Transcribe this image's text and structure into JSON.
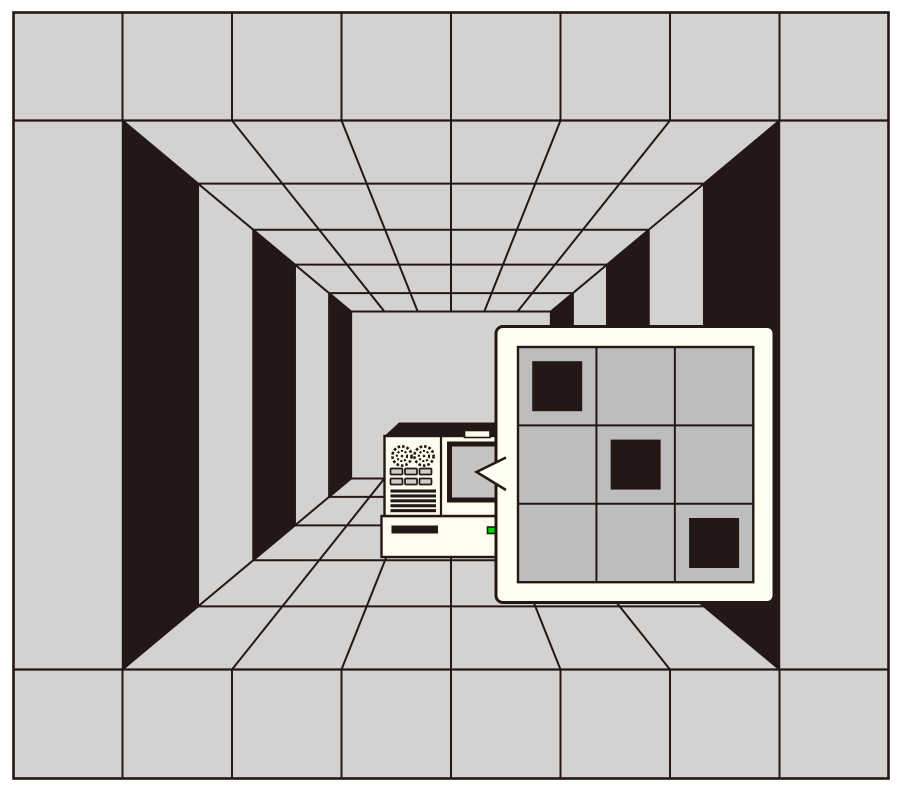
{
  "illustration": {
    "kind": "one-point-perspective corridor with computer and magnified screen callout",
    "has_text": false
  },
  "colors": {
    "background": "#ffffff",
    "wall_gray": "#d4d2d0",
    "line_dark": "#231815",
    "opening_black": "#231815",
    "panel_cream": "#fffff2",
    "device_cream": "#fdfcee",
    "grid_cell_gray": "#bdbdbd",
    "filled_square_dark": "#231815",
    "screen_gray": "#c6c4c2",
    "button_gray": "#d1cec9",
    "led_green": "#00d300"
  },
  "corridor": {
    "vanishing_point": {
      "x": 451,
      "y": 395
    },
    "half_width": 328.5,
    "half_height": 274.5,
    "depth_scales": [
      1,
      0.77,
      0.602,
      0.475,
      0.371,
      0.304
    ],
    "band_divider_xs": [
      122.5,
      232,
      341.5,
      451,
      560.5,
      670,
      779.5
    ],
    "outer_cells_per_band": 8,
    "door_openings_per_side": 3,
    "frame": {
      "x": 13.5,
      "y": 12.5,
      "w": 875,
      "h": 766
    },
    "band_top_y": 120.5,
    "band_bottom_y": 669.5
  },
  "computer": {
    "fans": 2,
    "fan_centers_x": [
      402,
      424
    ],
    "fan_center_y": 456,
    "button_rows_y": [
      468.5,
      478.5
    ],
    "button_cols_x": [
      390.5,
      405,
      419.5
    ],
    "vent_bars": 5,
    "has_monitor": true,
    "has_drive_slot": true,
    "power_led_on": true
  },
  "magnifier": {
    "rows": 3,
    "cols": 3,
    "filled_cells": [
      [
        0,
        0
      ],
      [
        1,
        1
      ],
      [
        2,
        2
      ]
    ],
    "square_size": 50,
    "grid": {
      "x": 518,
      "y": 347,
      "w": 235.3,
      "h": 235.2
    },
    "panel": {
      "x": 496,
      "y": 326.5,
      "w": 278,
      "h": 276,
      "corner_radius": 7
    },
    "pointer_tip": {
      "x": 476.5,
      "y": 472
    }
  }
}
